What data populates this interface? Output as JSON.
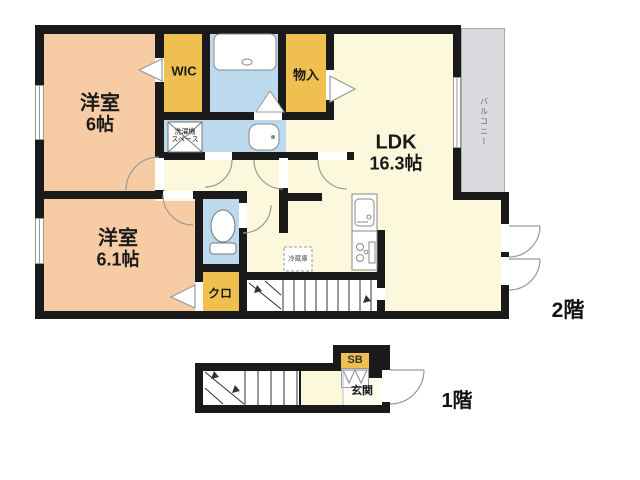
{
  "title": "2階建て住戸 間取り図",
  "floors": {
    "second": "2階",
    "first": "1階"
  },
  "rooms": {
    "bedroom1": {
      "name": "洋室",
      "size": "6帖"
    },
    "bedroom2": {
      "name": "洋室",
      "size": "6.1帖"
    },
    "ldk": {
      "name": "LDK",
      "size": "16.3帖"
    },
    "wic": "WIC",
    "storage": "物入",
    "laundry_line1": "洗濯機",
    "laundry_line2": "スペース",
    "closet": "クロ",
    "fridge": "冷蔵庫",
    "balcony": "バルコニー",
    "shoebox": "SB",
    "entrance": "玄関"
  },
  "colors": {
    "wall": "#1a1a1a",
    "room_peach": "#F7CBA4",
    "accent_yellow": "#EFC050",
    "floor_cream": "#FBF8DC",
    "water_blue": "#BCD9EE",
    "balcony_gray": "#DBDBDF",
    "stair_white": "#FFFFFF"
  }
}
